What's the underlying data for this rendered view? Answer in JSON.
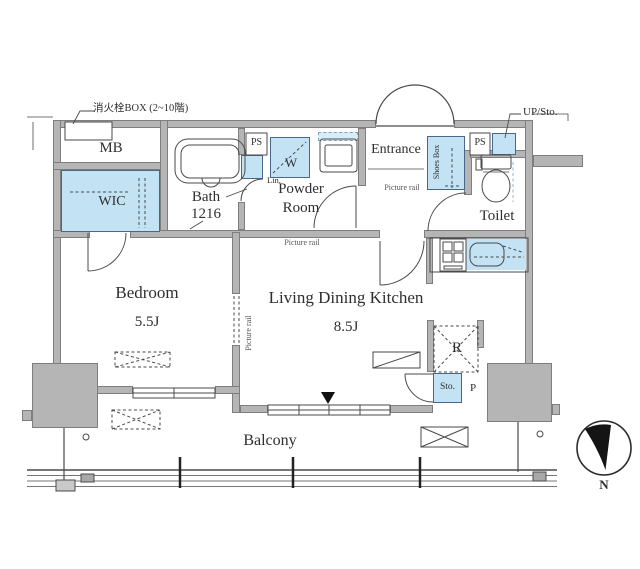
{
  "colors": {
    "wall_gray": "#b5b5b5",
    "fixture_blue": "#c3e2f3",
    "line": "#4a4a4a",
    "text": "#2e2e2e"
  },
  "labels": {
    "fire_box": "消火栓BOX (2~10階)",
    "meter_box": "MB",
    "wic": "WIC",
    "bath": "Bath",
    "bath_size": "1216",
    "ps_left": "PS",
    "washer": "W",
    "linen": "Lin.",
    "powder_room": "Powder Room",
    "entrance": "Entrance",
    "picture_rail_hall": "Picture rail",
    "picture_rail_ldk": "Picture rail",
    "picture_rail_partition": "Picture rail",
    "shoes_box": "Shoes Box",
    "ps_right": "PS",
    "up_storage": "UP/Sto.",
    "toilet": "Toilet",
    "bedroom": "Bedroom",
    "bedroom_size": "5.5J",
    "ldk": "Living Dining Kitchen",
    "ldk_size": "8.5J",
    "refrigerator": "R",
    "storage": "Sto.",
    "pipe_space": "P",
    "balcony": "Balcony",
    "compass_north": "N"
  }
}
